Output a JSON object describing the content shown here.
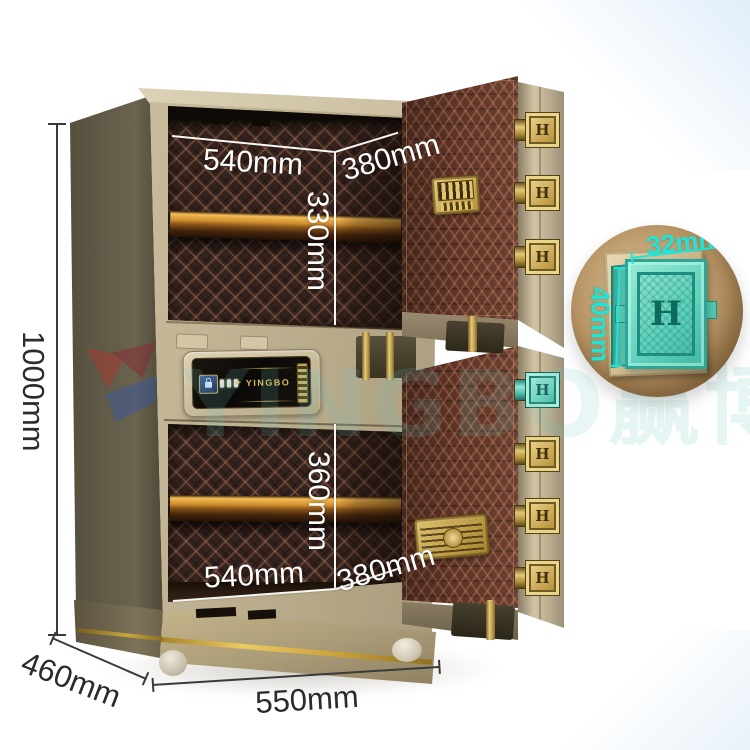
{
  "product": {
    "brand": "YINGBO",
    "bolt_letter": "H"
  },
  "icons": {
    "diamond": "✦"
  },
  "watermark": {
    "latin": "YINGBO",
    "cjk": "赢博"
  },
  "annotations": {
    "height": "1000mm",
    "base_depth": "460mm",
    "base_width": "550mm",
    "top_compartment": {
      "width": "540mm",
      "depth": "380mm",
      "height": "330mm"
    },
    "bottom_compartment": {
      "width": "540mm",
      "depth": "380mm",
      "height": "360mm"
    },
    "bolt": {
      "width": "32mm",
      "height": "40mm"
    }
  },
  "colors": {
    "cabinet_beige": "#c4b694",
    "side_panel": "#5e5846",
    "interior_brown": "#35231e",
    "door_brown": "#623629",
    "gold_trim": "#d9b95f",
    "callout_cyan": "#21e4d6",
    "label_dark": "#2b2b2b",
    "label_light": "#ffffff"
  }
}
